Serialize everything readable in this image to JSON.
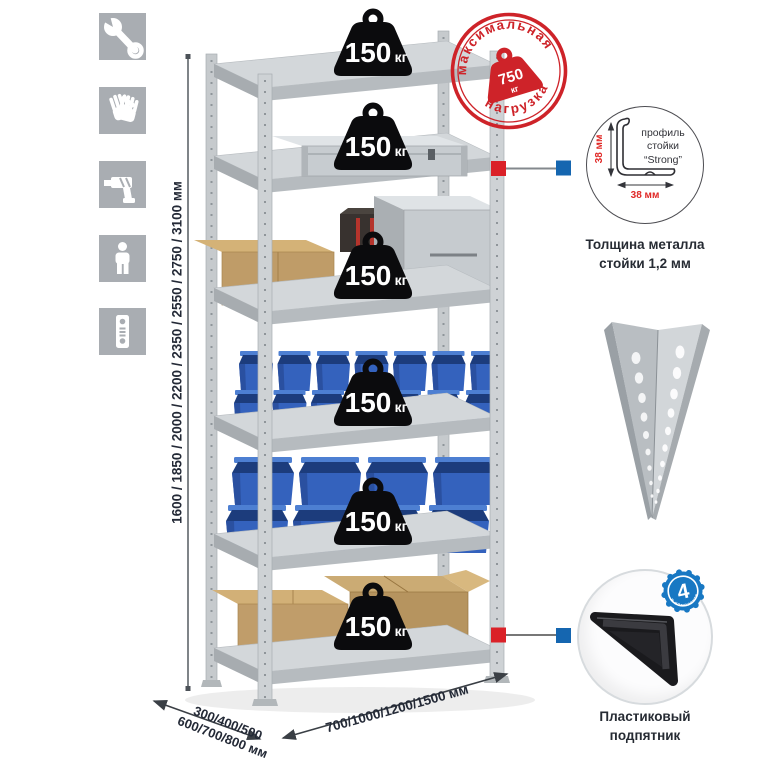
{
  "feature_icons": [
    {
      "name": "wrench-icon"
    },
    {
      "name": "gloves-icon"
    },
    {
      "name": "drill-icon"
    },
    {
      "name": "person-icon"
    },
    {
      "name": "level-icon"
    }
  ],
  "rack": {
    "shelf_count": 6,
    "shelf_load_value": "150",
    "shelf_load_unit": "кг"
  },
  "stamp": {
    "arc_top": "максимальная",
    "arc_bottom": "нагрузка",
    "value": "750",
    "unit": "кг"
  },
  "dimensions": {
    "height": "1600 / 1850 / 2000 / 2200 / 2350 / 2550 / 2750 / 3100 мм",
    "depth_line1": "300/400/500",
    "depth_line2": "600/700/800 мм",
    "width": "700/1000/1200/1500 мм"
  },
  "profile_detail": {
    "label_line1": "профиль",
    "label_line2": "стойки",
    "label_line3": "“Strong”",
    "dim_vertical": "38 мм",
    "dim_horizontal": "38 мм",
    "caption_line1": "Толщина металла",
    "caption_line2": "стойки 1,2 мм"
  },
  "foot_detail": {
    "badge_value": "4",
    "badge_arc": "в комплекте",
    "caption_line1": "Пластиковый",
    "caption_line2": "подпятник"
  },
  "colors": {
    "stamp_red": "#ce2329",
    "accent_red": "#da2128",
    "accent_blue": "#1566b0",
    "bin_blue": "#3462bd",
    "metal_gray": "#c9cdd0",
    "icon_gray": "#a9adb2"
  }
}
